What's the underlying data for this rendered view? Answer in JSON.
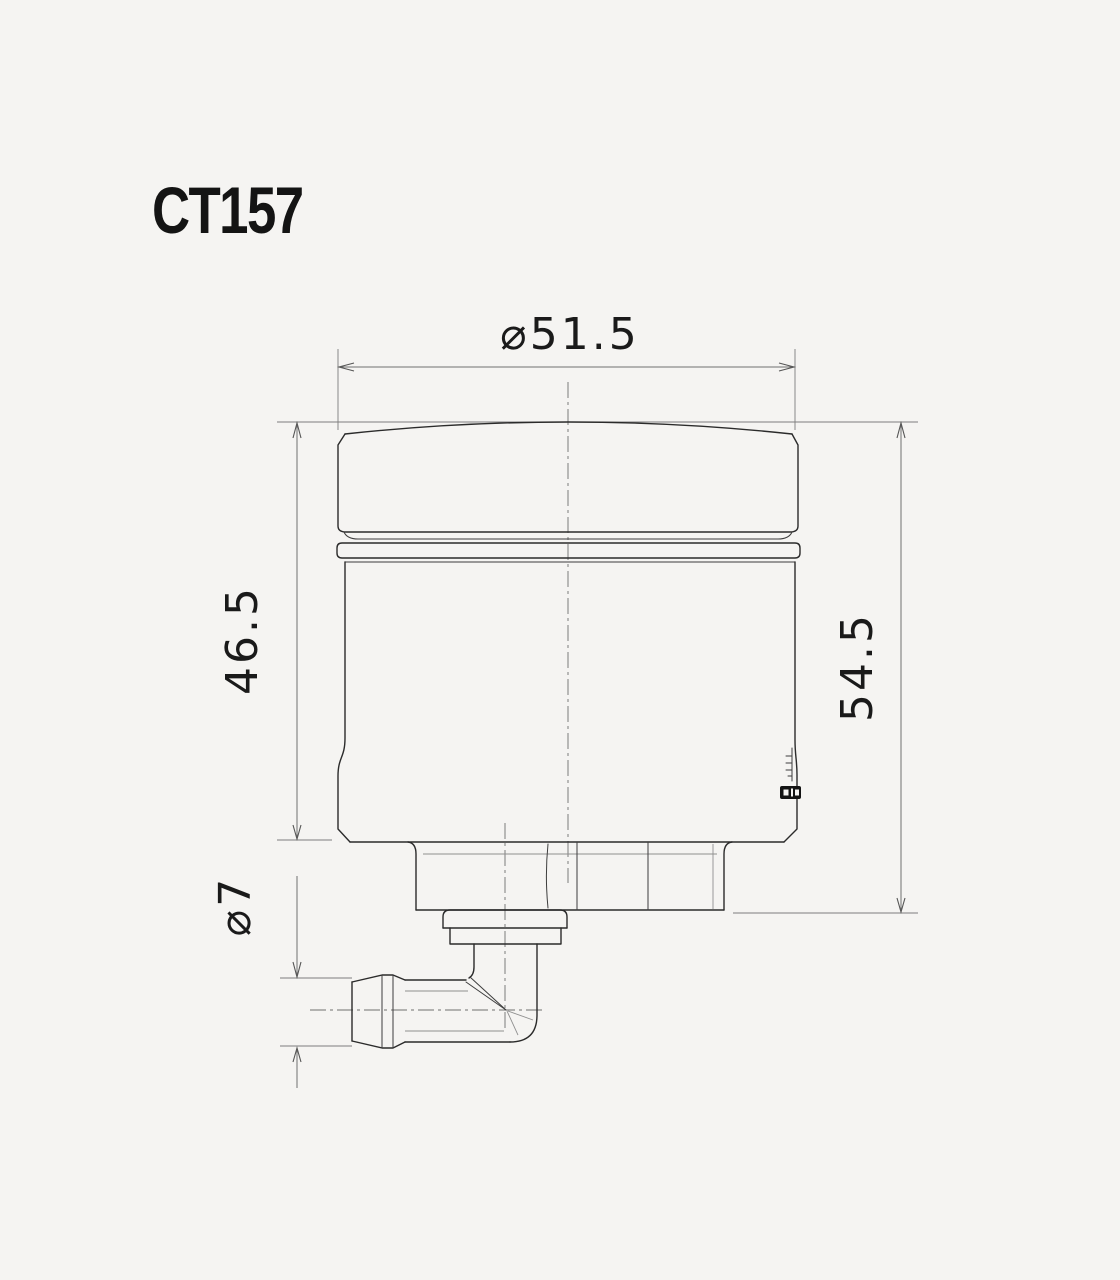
{
  "title": "CT157",
  "dimensions": {
    "cap_diameter": "⌀51.5",
    "body_height": "46.5",
    "total_height": "54.5",
    "outlet_diameter": "⌀7"
  },
  "drawing": {
    "type": "technical-orthographic-view",
    "subject": "fluid-reservoir-side-view",
    "parts": [
      "cap",
      "cap-dome",
      "mounting-ring",
      "reservoir-body",
      "base-nut",
      "outlet-steps",
      "elbow-fitting",
      "hose-barb",
      "level-marks",
      "brand-logo"
    ],
    "units_implied": "mm",
    "colors": {
      "background": "#f5f4f2",
      "outline": "#2b2b2b",
      "dimension_lines": "#707070",
      "text": "#1a1a1a"
    }
  }
}
